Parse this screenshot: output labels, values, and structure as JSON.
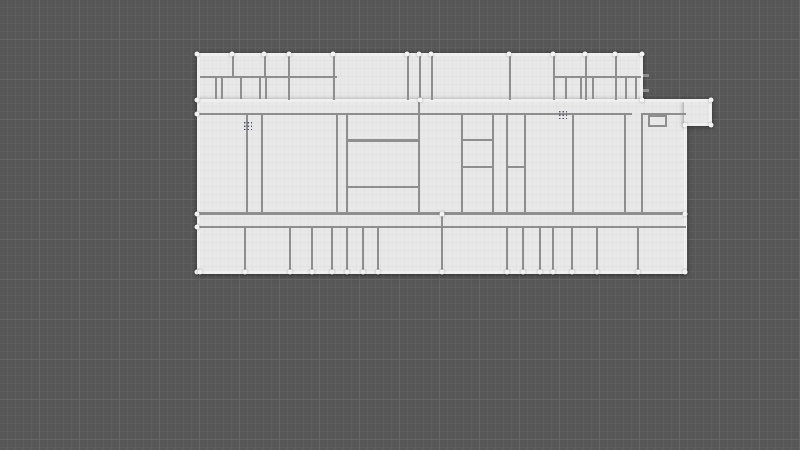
{
  "canvas": {
    "background": "#575757",
    "grid": {
      "minor_color": "#5f5f5f",
      "major_color": "#666666",
      "minor_step": 8,
      "major_step": 40
    }
  },
  "floorplan": {
    "floor_color": "#e8e8e8",
    "floor_grid_color": "#e2e2e2",
    "wall_colors": {
      "interior": "#8e8e8e",
      "outer": "#efefef"
    },
    "handle_color": "#f3f3f3",
    "dot_handle_color": "#4d5266",
    "slabs": [
      [
        197,
        53,
        446,
        49
      ],
      [
        197,
        99,
        490,
        175
      ],
      [
        684,
        99,
        28,
        27
      ]
    ],
    "outer_walls": [
      [
        197,
        53,
        446,
        3
      ],
      [
        640,
        53,
        3,
        48
      ],
      [
        197,
        99,
        515,
        3
      ],
      [
        197,
        53,
        3,
        221
      ],
      [
        197,
        271,
        490,
        3
      ],
      [
        684,
        123,
        3,
        151
      ],
      [
        709,
        99,
        3,
        27
      ],
      [
        684,
        123,
        28,
        3
      ]
    ],
    "interior_walls": [
      [
        200,
        76,
        137,
        2
      ],
      [
        553,
        76,
        88,
        2
      ],
      [
        232,
        55,
        2,
        22
      ],
      [
        264,
        55,
        2,
        22
      ],
      [
        215,
        77,
        2,
        22
      ],
      [
        221,
        77,
        2,
        22
      ],
      [
        240,
        77,
        2,
        22
      ],
      [
        259,
        77,
        2,
        22
      ],
      [
        265,
        77,
        2,
        22
      ],
      [
        288,
        55,
        2,
        45
      ],
      [
        333,
        55,
        2,
        45
      ],
      [
        407,
        55,
        2,
        45
      ],
      [
        419,
        55,
        2,
        45
      ],
      [
        431,
        55,
        2,
        45
      ],
      [
        509,
        55,
        2,
        45
      ],
      [
        553,
        55,
        2,
        45
      ],
      [
        585,
        55,
        2,
        45
      ],
      [
        615,
        55,
        2,
        45
      ],
      [
        565,
        77,
        2,
        22
      ],
      [
        580,
        77,
        2,
        22
      ],
      [
        592,
        77,
        2,
        22
      ],
      [
        625,
        77,
        2,
        22
      ],
      [
        635,
        77,
        2,
        22
      ],
      [
        643,
        74,
        6,
        3
      ],
      [
        643,
        89,
        6,
        3
      ],
      [
        197,
        113,
        435,
        2
      ],
      [
        642,
        113,
        44,
        2
      ],
      [
        246,
        113,
        2,
        102
      ],
      [
        261,
        113,
        2,
        102
      ],
      [
        336,
        113,
        2,
        102
      ],
      [
        346,
        113,
        2,
        102
      ],
      [
        418,
        99,
        2,
        116
      ],
      [
        461,
        113,
        2,
        102
      ],
      [
        492,
        113,
        2,
        102
      ],
      [
        506,
        113,
        2,
        102
      ],
      [
        524,
        113,
        2,
        102
      ],
      [
        572,
        113,
        2,
        102
      ],
      [
        624,
        113,
        2,
        102
      ],
      [
        641,
        113,
        2,
        100
      ],
      [
        347,
        139,
        72,
        3
      ],
      [
        347,
        186,
        72,
        2
      ],
      [
        462,
        139,
        31,
        2
      ],
      [
        462,
        166,
        31,
        2
      ],
      [
        507,
        166,
        18,
        2
      ],
      [
        197,
        212,
        489,
        3
      ],
      [
        441,
        212,
        2,
        16
      ],
      [
        197,
        226,
        489,
        2
      ],
      [
        244,
        227,
        2,
        46
      ],
      [
        289,
        227,
        2,
        46
      ],
      [
        311,
        227,
        2,
        46
      ],
      [
        331,
        227,
        2,
        46
      ],
      [
        346,
        227,
        2,
        46
      ],
      [
        362,
        227,
        2,
        46
      ],
      [
        377,
        227,
        2,
        46
      ],
      [
        441,
        227,
        2,
        46
      ],
      [
        506,
        227,
        2,
        46
      ],
      [
        522,
        227,
        2,
        46
      ],
      [
        539,
        227,
        2,
        46
      ],
      [
        552,
        227,
        2,
        46
      ],
      [
        571,
        227,
        2,
        46
      ],
      [
        596,
        227,
        2,
        46
      ],
      [
        637,
        227,
        2,
        46
      ]
    ],
    "fixtures": [
      [
        648,
        115,
        19,
        12
      ]
    ],
    "vertex_handles": [
      [
        197,
        54
      ],
      [
        232,
        54
      ],
      [
        264,
        54
      ],
      [
        289,
        54
      ],
      [
        333,
        54
      ],
      [
        407,
        54
      ],
      [
        419,
        54
      ],
      [
        431,
        54
      ],
      [
        509,
        54
      ],
      [
        553,
        54
      ],
      [
        585,
        54
      ],
      [
        615,
        54
      ],
      [
        642,
        54
      ],
      [
        197,
        100
      ],
      [
        197,
        114
      ],
      [
        197,
        214
      ],
      [
        197,
        227
      ],
      [
        197,
        272
      ],
      [
        711,
        100
      ],
      [
        711,
        125
      ],
      [
        685,
        125
      ],
      [
        685,
        214
      ],
      [
        685,
        272
      ],
      [
        642,
        100
      ],
      [
        420,
        100
      ],
      [
        442,
        214
      ],
      [
        200,
        272
      ],
      [
        245,
        272
      ],
      [
        290,
        272
      ],
      [
        312,
        272
      ],
      [
        332,
        272
      ],
      [
        347,
        272
      ],
      [
        363,
        272
      ],
      [
        378,
        272
      ],
      [
        442,
        272
      ],
      [
        507,
        272
      ],
      [
        523,
        272
      ],
      [
        540,
        272
      ],
      [
        553,
        272
      ],
      [
        572,
        272
      ],
      [
        597,
        272
      ],
      [
        638,
        272
      ]
    ],
    "dot_handles": [
      [
        243,
        121
      ],
      [
        558,
        110
      ]
    ]
  }
}
